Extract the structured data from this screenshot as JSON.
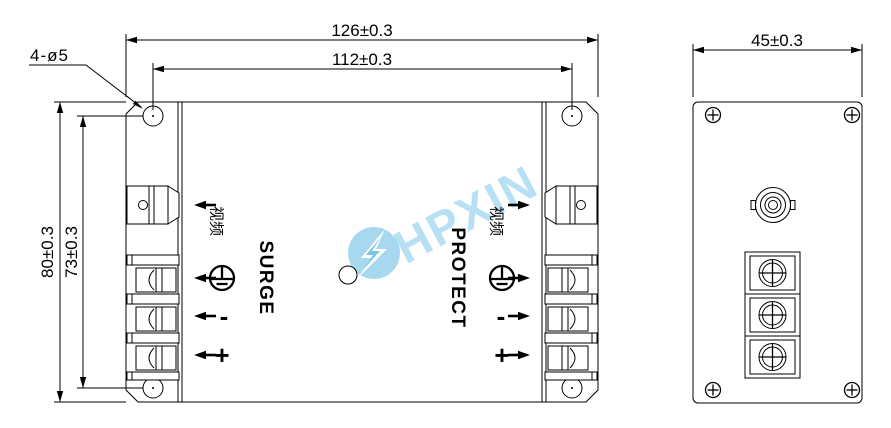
{
  "drawing": {
    "dimensions": {
      "overall_width": "126±0.3",
      "hole_spacing_horizontal": "112±0.3",
      "side_depth": "45±0.3",
      "overall_height": "80±0.3",
      "hole_spacing_vertical": "73±0.3",
      "mounting_holes_callout": "4-ø5"
    },
    "front_view": {
      "surge_label": "SURGE",
      "protect_label": "PROTECT",
      "video_port_label": "视频",
      "minus_label": "-",
      "plus_label": "+"
    },
    "watermark": {
      "text": "HPXIN",
      "text_color": "#b7e0f5",
      "logo_color": "#a8d8f0",
      "bolt_accent": "#7cc5ea"
    },
    "colors": {
      "line": "#000000",
      "background": "#ffffff"
    }
  }
}
